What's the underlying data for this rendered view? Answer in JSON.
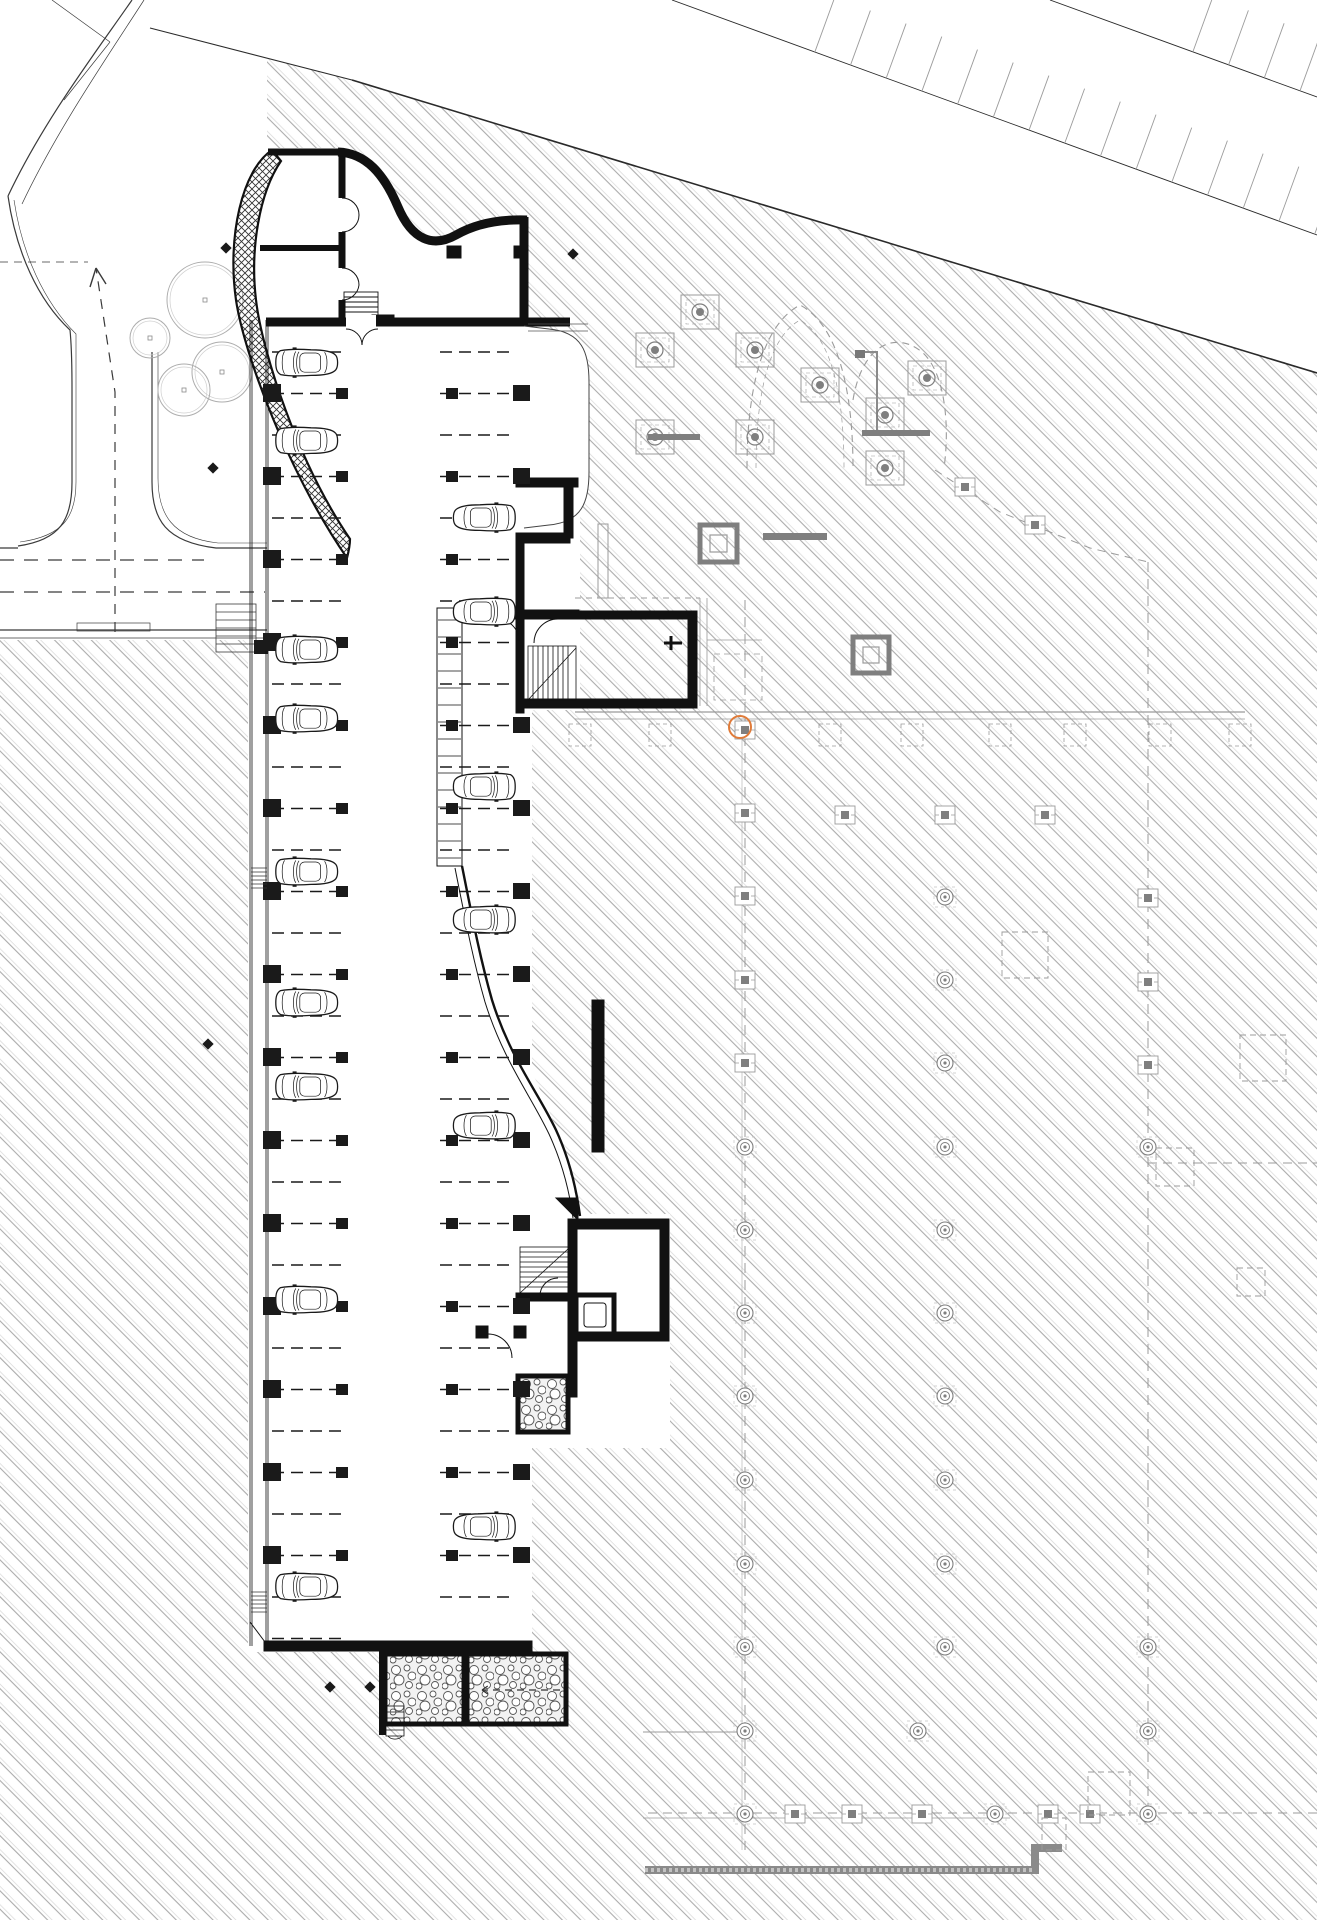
{
  "colors": {
    "background": "#ffffff",
    "line": "#1a1a1a",
    "hatch_dark": "#ababab",
    "hatch_light": "#d6d6d6",
    "ghost": "#9b9b9b",
    "ghost_dark": "#7f7f7f",
    "stone_line": "#555555",
    "accent_orange": "#e07b39"
  },
  "marker": {
    "orange_circle": {
      "x": 740,
      "y": 727,
      "r": 11
    }
  },
  "cars": {
    "left_x": 275,
    "right_x": 516,
    "scale": 0.8,
    "left_cy": [
      363,
      441,
      650,
      719,
      872,
      1003,
      1087,
      1300,
      1587
    ],
    "right_cy": [
      518,
      612,
      787,
      920,
      1126,
      1527
    ]
  },
  "stalls": {
    "y0": 352,
    "dy": 41.5,
    "count": 32,
    "left": {
      "x1": 272,
      "x2": 348
    },
    "right": {
      "x1": 440,
      "x2": 516,
      "max_y": 1612
    }
  },
  "columns": {
    "y0": 393,
    "dy": 83,
    "count": 15,
    "wall_x": 263,
    "stall_end_x": 336,
    "right_start_x": 446,
    "right_wall_x": 513,
    "skip_right_wall_rows": [
      2,
      3
    ]
  },
  "striping": {
    "row1": {
      "x1": 672,
      "y1": 0,
      "x2": 1317,
      "y2": 235,
      "spacing": 38,
      "len": 58
    },
    "row2": {
      "x1": 1050,
      "y1": 0,
      "x2": 1317,
      "y2": 97,
      "spacing": 38,
      "len": 58
    }
  },
  "trees": [
    [
      205,
      300,
      38
    ],
    [
      222,
      372,
      30
    ],
    [
      184,
      390,
      26
    ],
    [
      150,
      338,
      20
    ]
  ],
  "dots": [
    [
      226,
      248
    ],
    [
      573,
      254
    ],
    [
      213,
      468
    ],
    [
      208,
      1044
    ],
    [
      330,
      1687
    ],
    [
      370,
      1687
    ]
  ],
  "ghost": {
    "capsA": [
      [
        655,
        350
      ],
      [
        700,
        312
      ],
      [
        755,
        350
      ],
      [
        655,
        437
      ],
      [
        755,
        437
      ],
      [
        820,
        385
      ],
      [
        885,
        415
      ],
      [
        885,
        468
      ],
      [
        927,
        378
      ]
    ],
    "capsB": [
      [
        745,
        730
      ],
      [
        745,
        813
      ],
      [
        745,
        896
      ],
      [
        745,
        980
      ],
      [
        745,
        1063
      ],
      [
        845,
        815
      ],
      [
        945,
        815
      ],
      [
        1045,
        815
      ],
      [
        1148,
        898
      ],
      [
        1148,
        982
      ],
      [
        1148,
        1065
      ],
      [
        795,
        1814
      ],
      [
        852,
        1814
      ],
      [
        922,
        1814
      ],
      [
        1048,
        1814
      ],
      [
        1090,
        1814
      ],
      [
        965,
        487
      ],
      [
        1035,
        525
      ]
    ],
    "capsC": [
      [
        745,
        1147
      ],
      [
        745,
        1230
      ],
      [
        745,
        1313
      ],
      [
        745,
        1396
      ],
      [
        745,
        1480
      ],
      [
        745,
        1564
      ],
      [
        745,
        1647
      ],
      [
        745,
        1731
      ],
      [
        745,
        1814
      ],
      [
        945,
        897
      ],
      [
        945,
        980
      ],
      [
        945,
        1063
      ],
      [
        945,
        1147
      ],
      [
        945,
        1230
      ],
      [
        945,
        1313
      ],
      [
        945,
        1396
      ],
      [
        945,
        1480
      ],
      [
        945,
        1564
      ],
      [
        945,
        1647
      ],
      [
        918,
        1731
      ],
      [
        995,
        1814
      ],
      [
        1148,
        1147
      ],
      [
        1148,
        1647
      ],
      [
        1148,
        1731
      ],
      [
        1148,
        1814
      ]
    ],
    "capsD": [
      [
        580,
        735
      ],
      [
        660,
        735
      ],
      [
        830,
        735
      ],
      [
        912,
        735
      ],
      [
        1000,
        735
      ],
      [
        1075,
        735
      ],
      [
        1160,
        735
      ],
      [
        1240,
        735
      ]
    ],
    "dashed_squares": [
      [
        1002,
        932,
        46,
        46
      ],
      [
        1240,
        1035,
        46,
        46
      ],
      [
        1156,
        1148,
        38,
        38
      ],
      [
        1237,
        1268,
        28,
        28
      ],
      [
        1088,
        1772,
        42,
        43
      ],
      [
        1042,
        1818,
        24,
        32
      ]
    ],
    "beams": [
      [
        763,
        533,
        64,
        7
      ],
      [
        648,
        434,
        52,
        6
      ],
      [
        862,
        430,
        68,
        6
      ]
    ],
    "dark_squares": [
      [
        700,
        525,
        37
      ],
      [
        853,
        637,
        36
      ]
    ]
  },
  "grilles": {
    "xs": [
      251,
      267
    ],
    "rows_y": [
      868,
      1592
    ],
    "lines": 6,
    "step": 4
  }
}
